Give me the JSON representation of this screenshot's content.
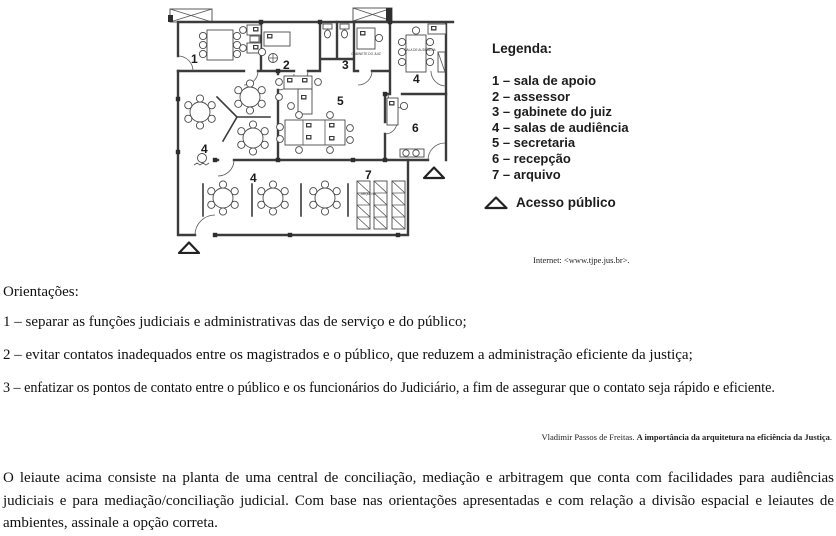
{
  "floor_plan": {
    "labels": {
      "room1": "1",
      "room2": "2",
      "room3": "3",
      "room4_top": "4",
      "room4_mid": "4",
      "room4_low": "4",
      "room5": "5",
      "room6": "6",
      "room7": "7"
    },
    "micro": {
      "gabinete": "GABINETE DO JUIZ",
      "sala_audiencia": "SALA DE AUDIÊNCIA",
      "arquivo": "ARQUIVO"
    }
  },
  "legend": {
    "title": "Legenda:",
    "items": [
      "1 – sala de apoio",
      "2 – assessor",
      "3 – gabinete do juiz",
      "4 – salas de audiência",
      "5 – secretaria",
      "6 – recepção",
      "7 – arquivo"
    ],
    "access_label": "Acesso público"
  },
  "source": "Internet: <www.tjpe.jus.br>.",
  "orientations": {
    "title": "Orientações:",
    "items": [
      "1 – separar as funções judiciais e administrativas das de serviço e do público;",
      "2 – evitar contatos inadequados entre os magistrados e o público, que reduzem a administração eficiente da justiça;",
      "3 – enfatizar os pontos de contato entre o público e os funcionários do Judiciário, a fim de assegurar que o contato seja rápido e eficiente."
    ]
  },
  "attribution": {
    "author": "Vladimir Passos de Freitas. ",
    "work": "A importância da arquitetura na eficiência da Justiça",
    "suffix": "."
  },
  "question": "O leiaute acima consiste na planta de uma central de conciliação, mediação e arbitragem que conta com facilidades para audiências judiciais e para mediação/conciliação judicial. Com base nas orientações apresentadas e com relação a divisão espacial e leiautes de ambientes, assinale a opção correta."
}
